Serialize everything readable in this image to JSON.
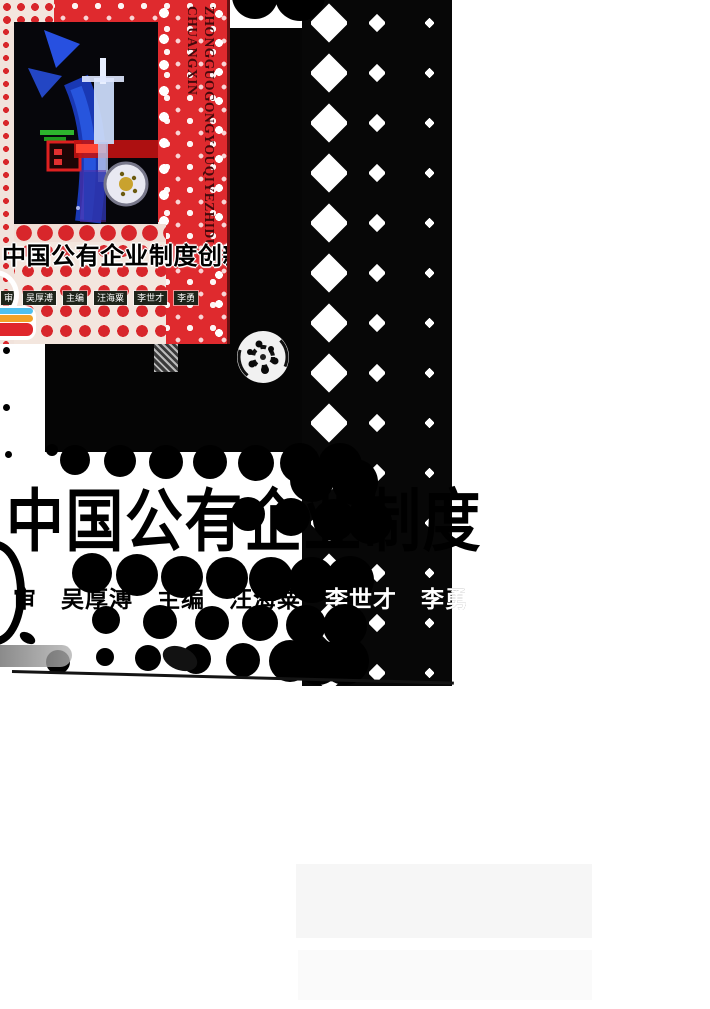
{
  "page": {
    "background": "#ffffff"
  },
  "cover": {
    "background_color": "#df2a2e",
    "pinyin_line1": "ZHONGGUOGONGYOUQIYEZHIDU",
    "pinyin_line2": "CHUANGXIN",
    "title": "中国公有企业制度创新",
    "credits": [
      {
        "label": "审"
      },
      {
        "label": "吴厚溥"
      },
      {
        "label": "主编"
      },
      {
        "label": "汪海粟"
      },
      {
        "label": "李世才"
      },
      {
        "label": "李勇"
      }
    ],
    "logo_stripe_colors": [
      "#4fc0ee",
      "#f2a227",
      "#e0272c"
    ]
  },
  "bw_scan": {
    "ink_color": "#000000",
    "title_partial": "中国公有企业制度",
    "credits_line": "审　吴厚溥　主编　汪海粟　李世才　李勇"
  }
}
